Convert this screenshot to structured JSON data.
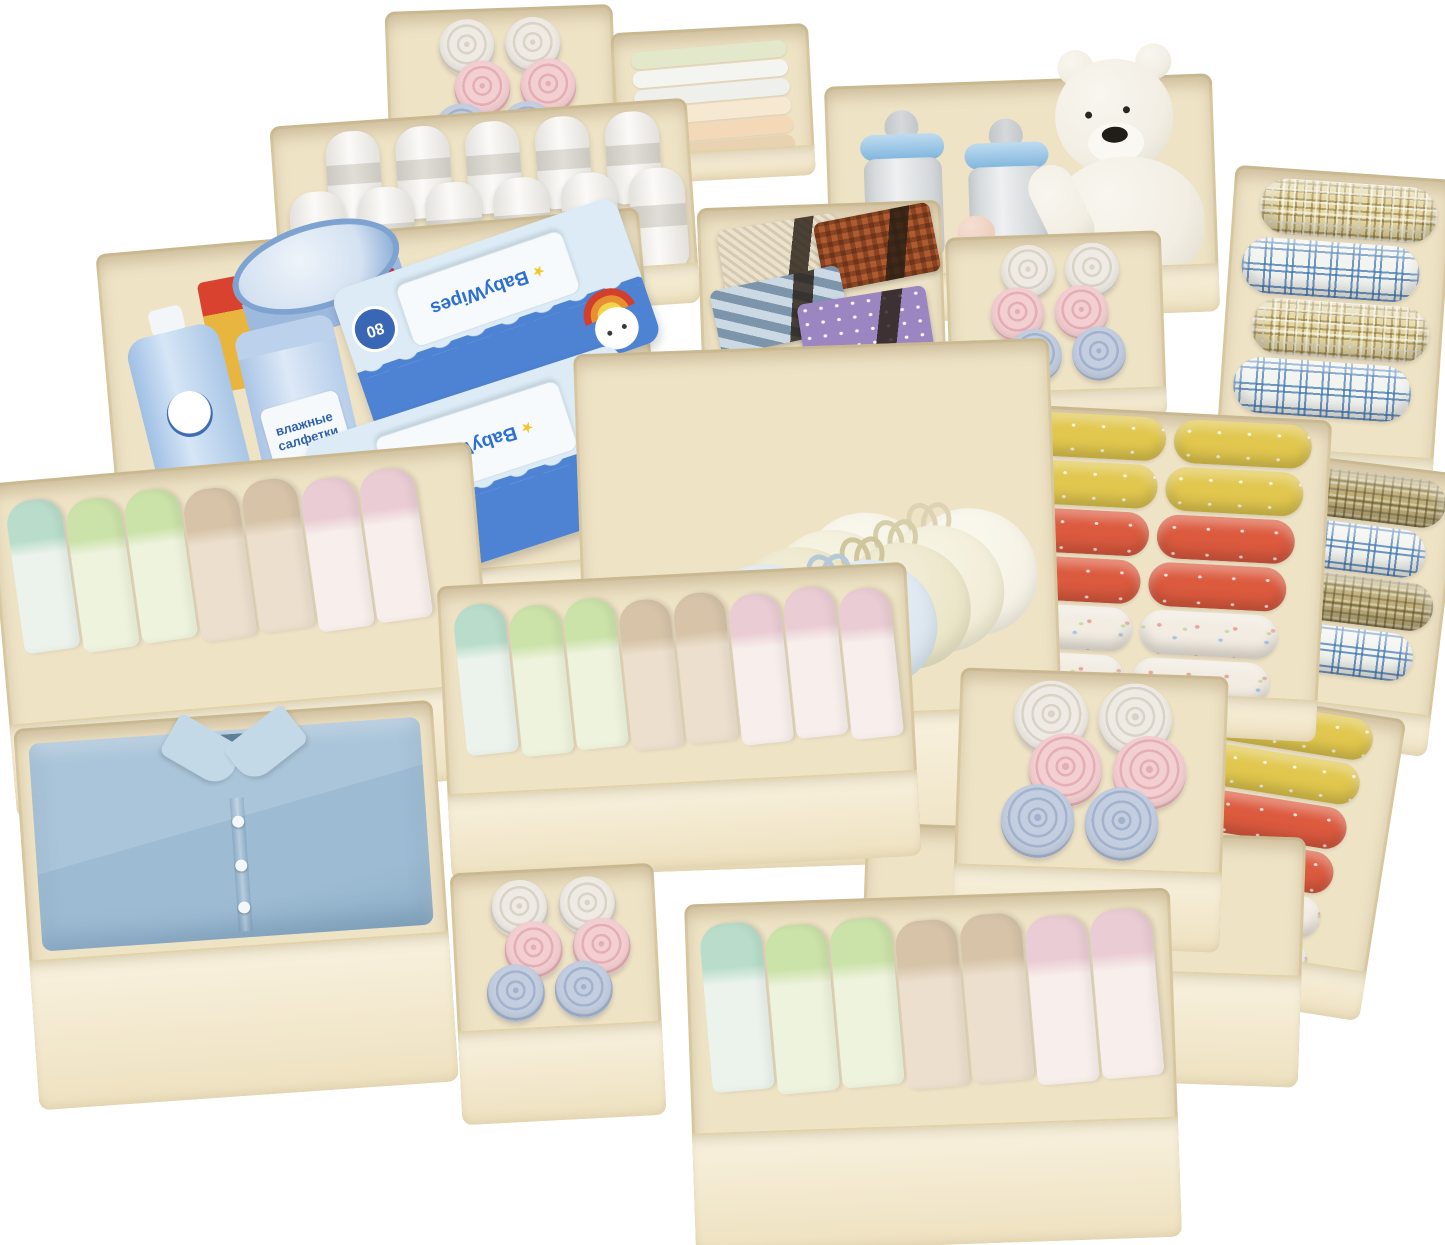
{
  "scene": {
    "description": "Product photo: set of beige fabric drawer organizer bins filled with baby items - rolled and folded baby clothes, white towels, plaid blankets, nursing bras, neckties, a folded blue shirt, two baby bottles, a white teddy bear, baby wipes packs and baby care products",
    "background": "#ffffff"
  },
  "texts": {
    "wipes_brand": "BabyWipes",
    "wipes_count": "80",
    "cyl_line1": "влажные",
    "cyl_line2": "салфетки"
  },
  "icons": {
    "star": "★"
  },
  "palette": {
    "bin": {
      "interior": "#efe3c6",
      "front_top": "#f8f1de",
      "front_bottom": "#eee1c0",
      "edge": "#e2d2a8"
    },
    "rolls": {
      "white": {
        "base": "#efebe4",
        "ring": "#d9d2c6"
      },
      "pink": {
        "base": "#f4cfd2",
        "ring": "#e3aeb4"
      },
      "blue": {
        "base": "#c3cee0",
        "ring": "#a3b2cc"
      }
    },
    "folds": {
      "mint": {
        "cap": "#b9ddca",
        "body": "#ebf3ec"
      },
      "green": {
        "cap": "#cbe2a9",
        "body": "#eef3dd"
      },
      "tan": {
        "cap": "#d6c3a8",
        "body": "#ecdfcd"
      },
      "pink": {
        "cap": "#eacdd4",
        "body": "#f8efec"
      }
    },
    "flat_layers": [
      "#e3e8cb",
      "#f4f4f0",
      "#eff0ec",
      "#f7e8d2",
      "#f3d9b8",
      "#e9d2b0"
    ],
    "towel": {
      "hi": "#fbfaf8",
      "lo": "#e3e1dc",
      "band": "#c9c6bf"
    },
    "bras": [
      {
        "base": "#ef764e",
        "hi": "#f59a77",
        "line": "#d55a33"
      },
      {
        "base": "#f08157",
        "hi": "#f6a685",
        "line": "#d8663c"
      },
      {
        "base": "#ccdbe7",
        "hi": "#e4edf4",
        "line": "#a9bfd1"
      },
      {
        "base": "#d9e4ed",
        "hi": "#ecf2f7",
        "line": "#b6c9d8"
      },
      {
        "base": "#e9e4c5",
        "hi": "#f3efd9",
        "line": "#cfc69d"
      },
      {
        "base": "#f0ebd4",
        "hi": "#f8f5e6",
        "line": "#d6cda9"
      },
      {
        "base": "#f5f1e3",
        "hi": "#fbf8ef",
        "line": "#ddd3b4"
      }
    ],
    "ties": [
      {
        "pattern": "weave",
        "color": "#eae2cf"
      },
      {
        "pattern": "check",
        "color": "#b05a2f"
      },
      {
        "pattern": "stripe",
        "color": "#a8bfcf"
      },
      {
        "pattern": "dots",
        "color": "#9c86c2"
      }
    ],
    "shirt": {
      "base": "#aac5da",
      "mid": "#9dbcd4",
      "dark": "#8fb0c9",
      "collar": "#c3d9e8",
      "neck": "#5f7f98",
      "button": "#f4f7f9"
    },
    "bear": {
      "fur": "#f2eee4",
      "fur_hi": "#f9f6ef",
      "shade": "#ded8c8",
      "nose": "#211e1a",
      "eye": "#2a2622",
      "muzzle": "#faf8f2"
    },
    "bottle": {
      "glass": "#ccd0d2",
      "glass_hi": "#eef0f1",
      "ring_hi": "#bedcf0",
      "ring_lo": "#7fb5dd",
      "nipple": "#d6d9db",
      "teat": "#eac8b8"
    },
    "care": {
      "lotion": "#a9c6e6",
      "lotion_hi": "#d6e6f6",
      "cap": "#f3f6f8",
      "logo": "#3f6db5",
      "cylinder": "#b6cdea",
      "cylinder_hi": "#dde9f7",
      "label_bg": "#f6f9fc",
      "label_text": "#2f62ae",
      "tin": "#9db9de",
      "tin_top": "#d3e1f1",
      "tin_rim": "#7ea3d1",
      "tin_label": "#c2384d",
      "carton_yellow": "#e8b53f",
      "carton_red": "#d8422f"
    },
    "wipes": {
      "pack": "#dcebf6",
      "wave": "#4e82d3",
      "lid": "#f7fafc",
      "lid_border": "#d3e0ea",
      "brand": "#2d6fd2",
      "brand_first": "#d93a2b",
      "badge": "#3a66b6",
      "badge_text": "#ffffff",
      "star": "#f2c832",
      "hat_red": "#d23f2c",
      "hat_orange": "#e6902f",
      "hat_yellow": "#f3d44a",
      "eye": "#3a3a3a"
    }
  },
  "bins": [
    {
      "id": "bottles-and-bear",
      "label": "baby bottles and plush bear",
      "x": 828,
      "y": 80,
      "w": 388,
      "h": 238,
      "rot": -2,
      "front": 46,
      "z": 1,
      "content": {
        "type": "bottles_bear"
      }
    },
    {
      "id": "rolled-clothes-top",
      "label": "rolled baby clothes",
      "x": 387,
      "y": 8,
      "w": 228,
      "h": 142,
      "rot": -2,
      "front": 26,
      "z": 2,
      "content": {
        "type": "rolls",
        "size": 56,
        "overlap": 14,
        "row_offsets": [
          0,
          14,
          -8
        ],
        "rows": [
          [
            "white",
            "white"
          ],
          [
            "pink",
            "pink"
          ],
          [
            "blue",
            "blue"
          ]
        ]
      }
    },
    {
      "id": "folded-cloths-top",
      "label": "stacked folded cloths",
      "x": 614,
      "y": 28,
      "w": 198,
      "h": 152,
      "rot": -3,
      "front": 28,
      "z": 2,
      "content": {
        "type": "flat_stack"
      }
    },
    {
      "id": "white-towels",
      "label": "rolled white towels",
      "x": 276,
      "y": 112,
      "w": 418,
      "h": 205,
      "rot": -4,
      "front": 38,
      "z": 3,
      "content": {
        "type": "towels"
      }
    },
    {
      "id": "plaid-blankets",
      "label": "rolled plaid blankets",
      "x": 1224,
      "y": 172,
      "w": 218,
      "h": 325,
      "rot": 4,
      "front": 44,
      "z": 3,
      "content": {
        "type": "plaid_rolls",
        "h": 56,
        "rolls": [
          "yellow",
          "blue",
          "yellow",
          "blue"
        ]
      }
    },
    {
      "id": "ties",
      "label": "folded neckties",
      "x": 700,
      "y": 204,
      "w": 244,
      "h": 196,
      "rot": -2,
      "front": 26,
      "z": 4,
      "content": {
        "type": "ties"
      }
    },
    {
      "id": "small-rolls",
      "label": "rolled baby washcloths",
      "x": 948,
      "y": 234,
      "w": 216,
      "h": 186,
      "rot": -2,
      "front": 28,
      "z": 4,
      "content": {
        "type": "rolls",
        "size": 54,
        "overlap": 12,
        "row_offsets": [
          6,
          -6,
          10
        ],
        "rows": [
          [
            "white",
            "white"
          ],
          [
            "pink",
            "pink"
          ],
          [
            "blue",
            "blue"
          ]
        ]
      }
    },
    {
      "id": "baby-care",
      "label": "baby care products and wipes",
      "x": 112,
      "y": 230,
      "w": 545,
      "h": 406,
      "rot": -5,
      "front": 58,
      "z": 5,
      "content": {
        "type": "care_set"
      }
    },
    {
      "id": "plaid-blankets-back",
      "label": "second set plaid blankets partial",
      "x": 1262,
      "y": 462,
      "w": 182,
      "h": 285,
      "rot": 7,
      "front": 40,
      "z": 4,
      "content": {
        "type": "plaid_rolls",
        "h": 48,
        "rolls": [
          "olive",
          "blue",
          "olive",
          "blue"
        ]
      }
    },
    {
      "id": "folded-clothes-right",
      "label": "folded baby clothes",
      "x": 1002,
      "y": 412,
      "w": 322,
      "h": 322,
      "rot": 3,
      "front": 40,
      "z": 6,
      "content": {
        "type": "folded_rows",
        "cols": 2,
        "row_h": 44,
        "rows": [
          "yellow",
          "yellow",
          "red",
          "red",
          "print",
          "print"
        ]
      }
    },
    {
      "id": "bras",
      "label": "nursing bras",
      "x": 582,
      "y": 346,
      "w": 476,
      "h": 520,
      "rot": -2,
      "front": 150,
      "z": 6,
      "content": {
        "type": "bras"
      }
    },
    {
      "id": "folded-clothes-back",
      "label": "second set folded clothes partial",
      "x": 1152,
      "y": 700,
      "w": 232,
      "h": 305,
      "rot": 9,
      "front": 48,
      "z": 5,
      "content": {
        "type": "folded_rows",
        "cols": 1,
        "row_h": 42,
        "rows": [
          "yellow",
          "yellow",
          "red",
          "red",
          "print",
          "print"
        ]
      }
    },
    {
      "id": "folded-underwear-left",
      "label": "folded baby underwear",
      "x": 2,
      "y": 462,
      "w": 484,
      "h": 336,
      "rot": -5,
      "front": 92,
      "z": 7,
      "content": {
        "type": "standing_folds",
        "w": 56,
        "h": 152,
        "items": [
          "mint",
          "green",
          "green",
          "tan",
          "tan",
          "pink",
          "pink"
        ]
      }
    },
    {
      "id": "empty-bin",
      "label": "empty organizer bin",
      "x": 862,
      "y": 830,
      "w": 440,
      "h": 250,
      "rot": 2,
      "front": 110,
      "z": 6,
      "content": {
        "type": "empty"
      }
    },
    {
      "id": "rolled-underwear-right",
      "label": "rolled baby clothes",
      "x": 956,
      "y": 672,
      "w": 268,
      "h": 276,
      "rot": 2,
      "front": 78,
      "z": 7,
      "content": {
        "type": "rolls",
        "size": 74,
        "overlap": 22,
        "row_offsets": [
          0,
          16,
          -10
        ],
        "rows": [
          [
            "white",
            "white"
          ],
          [
            "pink",
            "pink"
          ],
          [
            "blue",
            "blue"
          ]
        ]
      }
    },
    {
      "id": "folded-underwear-center",
      "label": "folded baby underwear",
      "x": 444,
      "y": 574,
      "w": 470,
      "h": 294,
      "rot": -3,
      "front": 84,
      "z": 8,
      "content": {
        "type": "standing_folds",
        "w": 52,
        "h": 150,
        "items": [
          "mint",
          "green",
          "green",
          "tan",
          "tan",
          "pink",
          "pink",
          "pink"
        ]
      }
    },
    {
      "id": "shirt",
      "label": "folded blue shirt",
      "x": 26,
      "y": 714,
      "w": 420,
      "h": 382,
      "rot": -4,
      "front": 148,
      "z": 9,
      "content": {
        "type": "shirt"
      }
    },
    {
      "id": "rolled-underwear-bottom",
      "label": "rolled baby clothes",
      "x": 456,
      "y": 868,
      "w": 204,
      "h": 252,
      "rot": -3,
      "front": 92,
      "z": 9,
      "content": {
        "type": "rolls",
        "size": 58,
        "overlap": 16,
        "row_offsets": [
          0,
          12,
          -8
        ],
        "rows": [
          [
            "white",
            "white"
          ],
          [
            "pink",
            "pink"
          ],
          [
            "blue",
            "blue"
          ]
        ]
      }
    },
    {
      "id": "folded-underwear-bottom",
      "label": "folded baby underwear",
      "x": 690,
      "y": 896,
      "w": 486,
      "h": 349,
      "rot": -2,
      "front": 118,
      "z": 10,
      "content": {
        "type": "standing_folds",
        "w": 62,
        "h": 168,
        "items": [
          "mint",
          "green",
          "green",
          "tan",
          "tan",
          "pink",
          "pink"
        ]
      }
    }
  ]
}
